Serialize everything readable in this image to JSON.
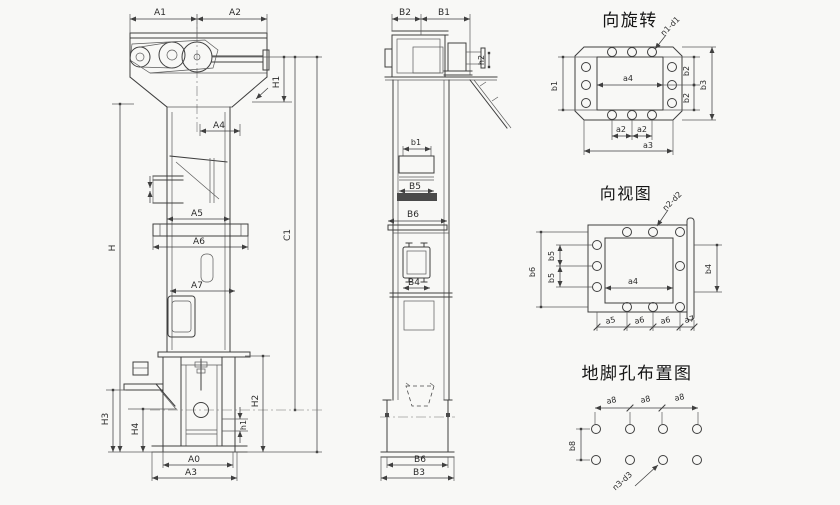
{
  "canvas": {
    "width": 840,
    "height": 505,
    "background": "#f8f8f6",
    "ink": "#3f3f3f"
  },
  "titles": {
    "rotation_view": "向旋转",
    "direction_view": "向视图",
    "anchor_view": "地脚孔布置图"
  },
  "front_view": {
    "labels": {
      "a1": "A1",
      "a2": "A2",
      "h1": "H1",
      "a4": "A4",
      "a5": "A5",
      "a6": "A6",
      "a7": "A7",
      "h": "H",
      "c1": "C1",
      "h2": "H2",
      "h3": "H3",
      "h4": "H4",
      "h_small": "h1",
      "a0": "A0",
      "a3": "A3"
    }
  },
  "side_view": {
    "labels": {
      "b2": "B2",
      "b1": "B1",
      "h2": "h2",
      "b1_small": "b1",
      "b5": "B5",
      "b6": "B6",
      "b4": "B4",
      "b6_bottom": "B6",
      "b3": "B3"
    }
  },
  "rotation_view": {
    "hole_note": "n1-d1",
    "labels": {
      "b1": "b1",
      "a4": "a4",
      "b2_upper": "b2",
      "b2_lower": "b2",
      "b3": "b3",
      "a2_left": "a2",
      "a2_right": "a2",
      "a3": "a3"
    }
  },
  "direction_view": {
    "hole_note": "n2-d2",
    "labels": {
      "b6": "b6",
      "b5_upper": "b5",
      "b5_lower": "b5",
      "a4": "a4",
      "b4": "b4",
      "a5": "a5",
      "a6_left": "a6",
      "a6_right": "a6",
      "a7": "a7"
    }
  },
  "anchor_view": {
    "hole_note": "n3-d3",
    "labels": {
      "a8_1": "a8",
      "a8_2": "a8",
      "a8_3": "a8",
      "b8": "b8"
    }
  }
}
